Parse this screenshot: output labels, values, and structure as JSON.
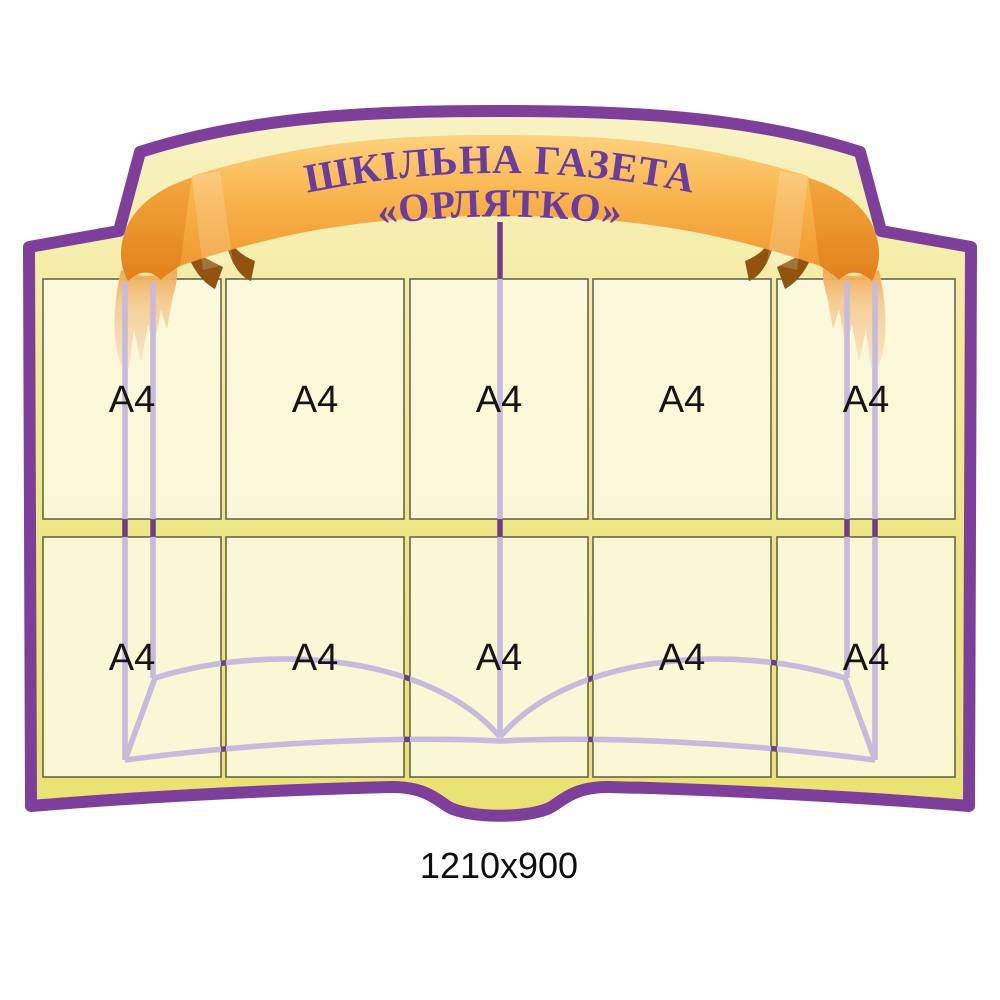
{
  "banner": {
    "line1": "ШКІЛЬНА ГАЗЕТА",
    "line2": "«ОРЛЯТКО»"
  },
  "caption": "1210x900",
  "grid": {
    "rows": 2,
    "columns": 5,
    "pocket_format": "A4"
  },
  "pockets": [
    {
      "label": "A4"
    },
    {
      "label": "A4"
    },
    {
      "label": "A4"
    },
    {
      "label": "A4"
    },
    {
      "label": "A4"
    },
    {
      "label": "A4"
    },
    {
      "label": "A4"
    },
    {
      "label": "A4"
    },
    {
      "label": "A4"
    },
    {
      "label": "A4"
    }
  ],
  "colors": {
    "frame_purple": "#7d3f9a",
    "board_yellow": "#ece674",
    "board_cream_top": "#f9f2c6",
    "pocket_cream": "#f8f5dc",
    "ribbon_orange": "#f6ae45",
    "ribbon_fold_dark": "#e8861f",
    "ribbon_shadow": "#91530f",
    "ribbon_tail_pale": "#f7ddb9",
    "banner_text_purple": "#6b3ca0",
    "book_line_dark": "#6d3c8c",
    "book_line_muted": "#c7badd",
    "label_black": "#151515"
  }
}
